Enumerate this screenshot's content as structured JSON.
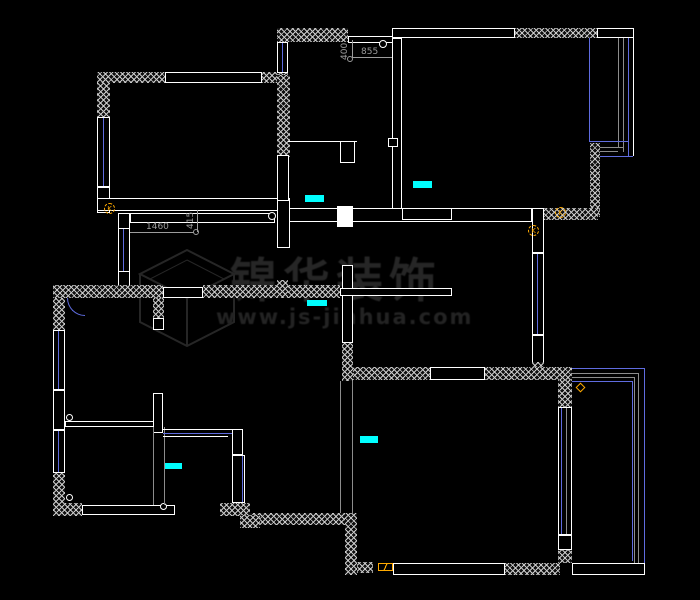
{
  "watermark": {
    "brand": "锦华装饰",
    "url": "www.js-jinhua.com"
  },
  "dims": {
    "d1460": "1460",
    "d415": "415",
    "d400": "400",
    "d855": "855"
  },
  "markers": {
    "k": "K"
  },
  "colors": {
    "bg": "#000000",
    "wall": "#ffffff",
    "window_blue": "#5f6ce0",
    "aux_gray": "#8c8c8c",
    "hatch_gray": "#c9c9c9",
    "marker_cyan": "#00ffff",
    "marker_orange": "#ffaa00",
    "dim_gray": "#9c9c9c",
    "watermark_gray": "#262626"
  }
}
